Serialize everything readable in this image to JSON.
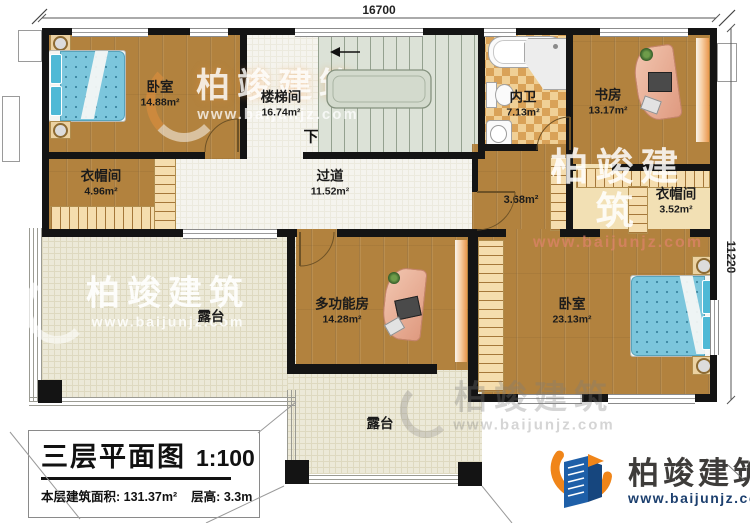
{
  "plan": {
    "dim_top": "16700",
    "dim_right": "11220",
    "stair_down": "下",
    "rooms": {
      "bedroom_tl": {
        "name": "卧室",
        "area": "14.88m²"
      },
      "stairwell": {
        "name": "楼梯间",
        "area": "16.74m²"
      },
      "closet_left": {
        "name": "衣帽间",
        "area": "4.96m²"
      },
      "corridor": {
        "name": "过道",
        "area": "11.52m²"
      },
      "bathroom": {
        "name": "内卫",
        "area": "7.13m²"
      },
      "study": {
        "name": "书房",
        "area": "13.17m²"
      },
      "hall": {
        "area": "3.68m²"
      },
      "closet_right": {
        "name": "衣帽间",
        "area": "3.52m²"
      },
      "multi_room": {
        "name": "多功能房",
        "area": "14.28m²"
      },
      "bedroom_br": {
        "name": "卧室",
        "area": "23.13m²"
      },
      "terrace_left": {
        "name": "露台"
      },
      "terrace_bottom": {
        "name": "露台"
      }
    }
  },
  "title_block": {
    "title": "三层平面图",
    "scale": "1:100",
    "area_label": "本层建筑面积:",
    "area_value": "131.37m²",
    "floor_height_label": "层高:",
    "floor_height_value": "3.3m"
  },
  "branding": {
    "company": "柏竣建筑",
    "website": "www.baijunjz.com"
  },
  "watermark": {
    "company": "柏竣建筑",
    "website": "www.baijunjz.com"
  },
  "colors": {
    "wall": "#141414",
    "wood_floor": "#b2823e",
    "terrace_floor": "#ece9d8",
    "stair_floor": "#dce2d7",
    "bath_checker_light": "#f0d096",
    "bath_checker_dark": "#d9a258",
    "bed_blue": "#7cc6dc",
    "desk_salmon": "#e9a58e",
    "logo_blue": "#1e5fa8",
    "logo_orange": "#f08519"
  }
}
